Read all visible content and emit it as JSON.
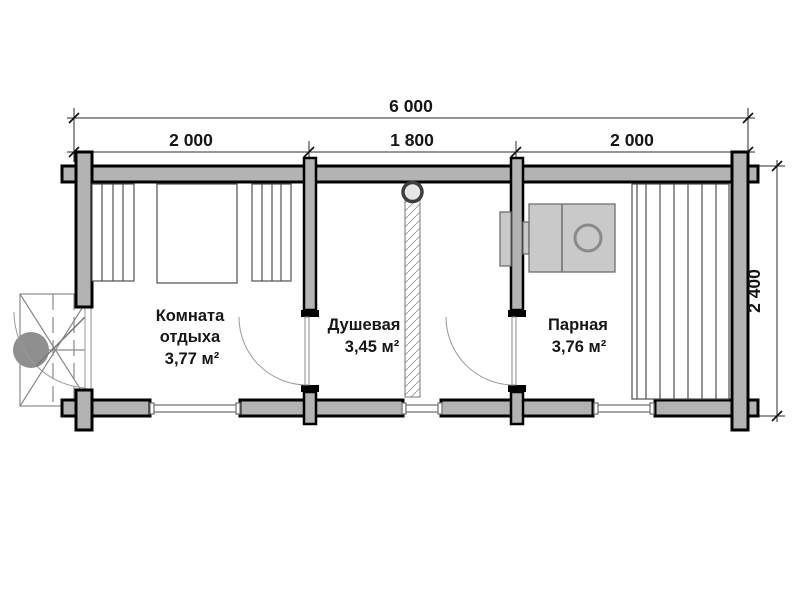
{
  "drawing": {
    "type": "floor-plan",
    "dimensions": {
      "overall": "6 000",
      "segments": [
        "2 000",
        "1 800",
        "2 000"
      ],
      "depth": "2 400"
    },
    "rooms": [
      {
        "name_lines": [
          "Комната",
          "отдыха"
        ],
        "area": "3,77 м²"
      },
      {
        "name_lines": [
          "Душевая"
        ],
        "area": "3,45 м²"
      },
      {
        "name_lines": [
          "Парная"
        ],
        "area": "3,76 м²"
      }
    ],
    "colors": {
      "wall_fill": "#b3b3b3",
      "wall_outline": "#000000",
      "stove_fill": "#c9c9c9",
      "text": "#161616",
      "background": "#ffffff"
    }
  }
}
